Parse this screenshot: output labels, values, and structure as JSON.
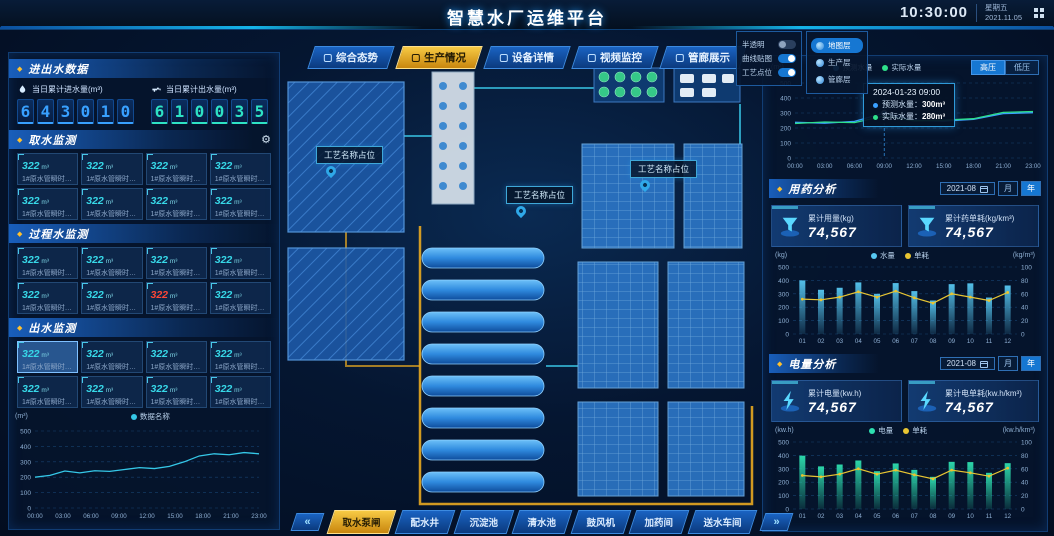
{
  "header": {
    "title": "智慧水厂运维平台",
    "time": "10:30:00",
    "weekday": "星期五",
    "date": "2021.11.05"
  },
  "nav": {
    "tabs": [
      {
        "label": "综合态势",
        "active": false
      },
      {
        "label": "生产情况",
        "active": true
      },
      {
        "label": "设备详情",
        "active": false
      },
      {
        "label": "视频监控",
        "active": false
      },
      {
        "label": "管廊展示",
        "active": false
      }
    ]
  },
  "map_controls": {
    "toggles": [
      {
        "label": "半透明",
        "on": false
      },
      {
        "label": "曲线贴图",
        "on": true
      },
      {
        "label": "工艺点位",
        "on": true
      }
    ],
    "layers": [
      {
        "label": "地图层",
        "active": true
      },
      {
        "label": "生产层",
        "active": false
      },
      {
        "label": "管廊层",
        "active": false
      }
    ]
  },
  "plant": {
    "labels": [
      "工艺名称占位",
      "工艺名称占位",
      "工艺名称占位"
    ]
  },
  "bottom_tabs": {
    "prev": "«",
    "next": "»",
    "tabs": [
      {
        "label": "取水泵闸",
        "active": true
      },
      {
        "label": "配水井",
        "active": false
      },
      {
        "label": "沉淀池",
        "active": false
      },
      {
        "label": "清水池",
        "active": false
      },
      {
        "label": "鼓风机",
        "active": false
      },
      {
        "label": "加药间",
        "active": false
      },
      {
        "label": "送水车间",
        "active": false
      }
    ]
  },
  "left_panel": {
    "title": "进出水数据",
    "stats": [
      {
        "label": "当日累计进水量(m³)",
        "digits": "643010",
        "color": "#38a0ff"
      },
      {
        "label": "当日累计出水量(m³)",
        "digits": "610035",
        "color": "#2ee2c4"
      }
    ],
    "sections": [
      {
        "title": "取水监测",
        "cards": [
          {
            "value": "322",
            "unit": "m³",
            "label": "1#原水管瞬时…"
          },
          {
            "value": "322",
            "unit": "m³",
            "label": "1#原水管瞬时…"
          },
          {
            "value": "322",
            "unit": "m³",
            "label": "1#原水管瞬时…"
          },
          {
            "value": "322",
            "unit": "m³",
            "label": "1#原水管瞬时…"
          },
          {
            "value": "322",
            "unit": "m³",
            "label": "1#原水管瞬时…"
          },
          {
            "value": "322",
            "unit": "m³",
            "label": "1#原水管瞬时…"
          },
          {
            "value": "322",
            "unit": "m³",
            "label": "1#原水管瞬时…"
          },
          {
            "value": "322",
            "unit": "m³",
            "label": "1#原水管瞬时…"
          }
        ]
      },
      {
        "title": "过程水监测",
        "cards": [
          {
            "value": "322",
            "unit": "m³",
            "label": "1#原水管瞬时…"
          },
          {
            "value": "322",
            "unit": "m³",
            "label": "1#原水管瞬时…"
          },
          {
            "value": "322",
            "unit": "m³",
            "label": "1#原水管瞬时…"
          },
          {
            "value": "322",
            "unit": "m³",
            "label": "1#原水管瞬时…"
          },
          {
            "value": "322",
            "unit": "m³",
            "label": "1#原水管瞬时…"
          },
          {
            "value": "322",
            "unit": "m³",
            "label": "1#原水管瞬时…"
          },
          {
            "value": "322",
            "unit": "m³",
            "label": "1#原水管瞬时…",
            "state": "alarm"
          },
          {
            "value": "322",
            "unit": "m³",
            "label": "1#原水管瞬时…"
          }
        ]
      },
      {
        "title": "出水监测",
        "cards": [
          {
            "value": "322",
            "unit": "m³",
            "label": "1#原水管瞬时…",
            "state": "selected"
          },
          {
            "value": "322",
            "unit": "m³",
            "label": "1#原水管瞬时…"
          },
          {
            "value": "322",
            "unit": "m³",
            "label": "1#原水管瞬时…"
          },
          {
            "value": "322",
            "unit": "m³",
            "label": "1#原水管瞬时…"
          },
          {
            "value": "322",
            "unit": "m³",
            "label": "1#原水管瞬时…"
          },
          {
            "value": "322",
            "unit": "m³",
            "label": "1#原水管瞬时…"
          },
          {
            "value": "322",
            "unit": "m³",
            "label": "1#原水管瞬时…"
          },
          {
            "value": "322",
            "unit": "m³",
            "label": "1#原水管瞬时…"
          }
        ]
      }
    ]
  },
  "med_analysis": {
    "title": "用药分析",
    "date": "2021-08",
    "period_month": "月",
    "period_year": "年",
    "tabs": [
      {
        "label": "液碱",
        "active": true
      },
      {
        "label": "次氯酸钠",
        "active": false
      }
    ],
    "stats": [
      {
        "label": "累计用量(kg)",
        "value": "74,567"
      },
      {
        "label": "累计药单耗(kg/km³)",
        "value": "74,567"
      }
    ]
  },
  "power_analysis": {
    "title": "电量分析",
    "date": "2021-08",
    "period_month": "月",
    "period_year": "年",
    "tabs": [
      {
        "label": "取水电耗",
        "active": true
      },
      {
        "label": "送水电耗",
        "active": false
      }
    ],
    "stats": [
      {
        "label": "累计电量(kw.h)",
        "value": "74,567"
      },
      {
        "label": "累计电单耗(kw.h/km³)",
        "value": "74,567"
      }
    ]
  },
  "colors": {
    "accent_cyan": "#35c8e8",
    "accent_blue": "#3aa0ff",
    "accent_teal": "#2ee2c4",
    "accent_green": "#2ee08a",
    "accent_gold": "#f5c23c",
    "alarm_red": "#ff4636",
    "bar_cyan": "#57c8f2",
    "bar_green": "#2ee0b0",
    "line_yellow": "#e8c532"
  },
  "chart_data": [
    {
      "type": "line",
      "unit": "(m³)",
      "x": [
        "00:00",
        "03:00",
        "06:00",
        "09:00",
        "12:00",
        "15:00",
        "18:00",
        "21:00",
        "23:00"
      ],
      "ylim": [
        0,
        500
      ],
      "yticks": [
        0,
        100,
        200,
        300,
        400,
        500
      ],
      "series": [
        {
          "name": "数据名称",
          "color": "#35c8e8",
          "values": [
            200,
            212,
            240,
            228,
            242,
            238,
            250,
            262,
            256,
            270,
            300,
            338,
            352,
            346,
            360,
            352
          ]
        }
      ]
    },
    {
      "type": "line",
      "unit": "(m³)",
      "x": [
        "00:00",
        "03:00",
        "06:00",
        "09:00",
        "12:00",
        "15:00",
        "18:00",
        "21:00",
        "23:00"
      ],
      "ylim": [
        0,
        500
      ],
      "yticks": [
        0,
        100,
        200,
        300,
        400,
        500
      ],
      "series": [
        {
          "name": "预测水量",
          "color": "#3aa0ff",
          "values": [
            238,
            232,
            244,
            300,
            252,
            246,
            258,
            296,
            302
          ]
        },
        {
          "name": "实际水量",
          "color": "#2ee08a",
          "values": [
            230,
            240,
            236,
            280,
            248,
            252,
            262,
            304,
            310
          ]
        }
      ],
      "buttons": [
        {
          "label": "高压",
          "active": true
        },
        {
          "label": "低压",
          "active": false
        }
      ],
      "tooltip": {
        "title": "2024-01-23 09:00",
        "rows": [
          {
            "label": "预测水量：",
            "value": "300m³",
            "color": "#3aa0ff"
          },
          {
            "label": "实际水量：",
            "value": "280m³",
            "color": "#2ee08a"
          }
        ],
        "x_index": 3
      }
    },
    {
      "type": "bar-line",
      "categories": [
        "01",
        "02",
        "03",
        "04",
        "05",
        "06",
        "07",
        "08",
        "09",
        "10",
        "11",
        "12"
      ],
      "left_unit": "(kg)",
      "right_unit": "(kg/m³)",
      "left_lim": [
        0,
        500
      ],
      "right_lim": [
        0,
        100
      ],
      "left_ticks": [
        0,
        100,
        200,
        300,
        400,
        500
      ],
      "right_ticks": [
        0,
        20,
        40,
        60,
        80,
        100
      ],
      "series": [
        {
          "name": "水量",
          "type": "bar",
          "color": "#57c8f2",
          "values": [
            400,
            330,
            345,
            385,
            300,
            380,
            320,
            250,
            372,
            378,
            272,
            362
          ]
        },
        {
          "name": "单耗",
          "type": "line",
          "color": "#e8c532",
          "values": [
            52,
            51,
            55,
            63,
            55,
            64,
            54,
            46,
            60,
            55,
            50,
            62
          ]
        }
      ]
    },
    {
      "type": "bar-line",
      "categories": [
        "01",
        "02",
        "03",
        "04",
        "05",
        "06",
        "07",
        "08",
        "09",
        "10",
        "11",
        "12"
      ],
      "left_unit": "(kw.h)",
      "right_unit": "(kw.h/km³)",
      "left_lim": [
        0,
        500
      ],
      "right_lim": [
        0,
        100
      ],
      "left_ticks": [
        0,
        100,
        200,
        300,
        400,
        500
      ],
      "right_ticks": [
        0,
        20,
        40,
        60,
        80,
        100
      ],
      "series": [
        {
          "name": "电量",
          "type": "bar",
          "color": "#2ee0b0",
          "values": [
            398,
            318,
            332,
            362,
            282,
            340,
            292,
            240,
            352,
            350,
            270,
            342
          ]
        },
        {
          "name": "单耗",
          "type": "line",
          "color": "#e8c532",
          "values": [
            50,
            48,
            52,
            60,
            52,
            58,
            51,
            45,
            58,
            54,
            49,
            61
          ]
        }
      ]
    }
  ]
}
